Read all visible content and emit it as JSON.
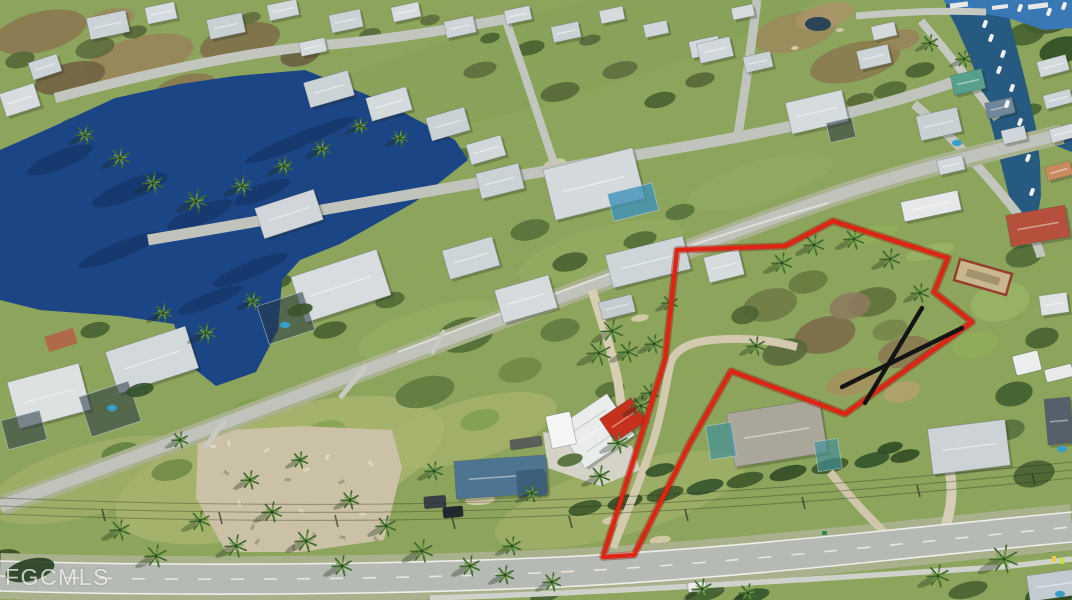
{
  "image": {
    "kind_label": "aerial-listing-photo",
    "watermark": "FGCMLS"
  },
  "palette": {
    "lake_blue": "#1c4585",
    "lake_shadow_blue": "#13305f",
    "canal_blue": "#275a80",
    "bay_blue": "#3878b4",
    "pool_blue": "#38a0c8",
    "grass_green": "#8ca45c",
    "road_gray": "#b6bab4",
    "dirt_tan": "#cbc1a6",
    "boundary_red": "#e02413",
    "boundary_red_dark": "#8f1408",
    "x_mark_black": "#141414",
    "watermark_white": "rgba(255,255,255,0.72)"
  },
  "overlay": {
    "boundary_points": "833,221 948,258 934,292 972,322 845,414 731,371 690,443 634,555 603,557 665,360 677,250 785,246",
    "x_mark_line_1": "922,308 865,403",
    "x_mark_line_2": "842,387 962,328"
  }
}
